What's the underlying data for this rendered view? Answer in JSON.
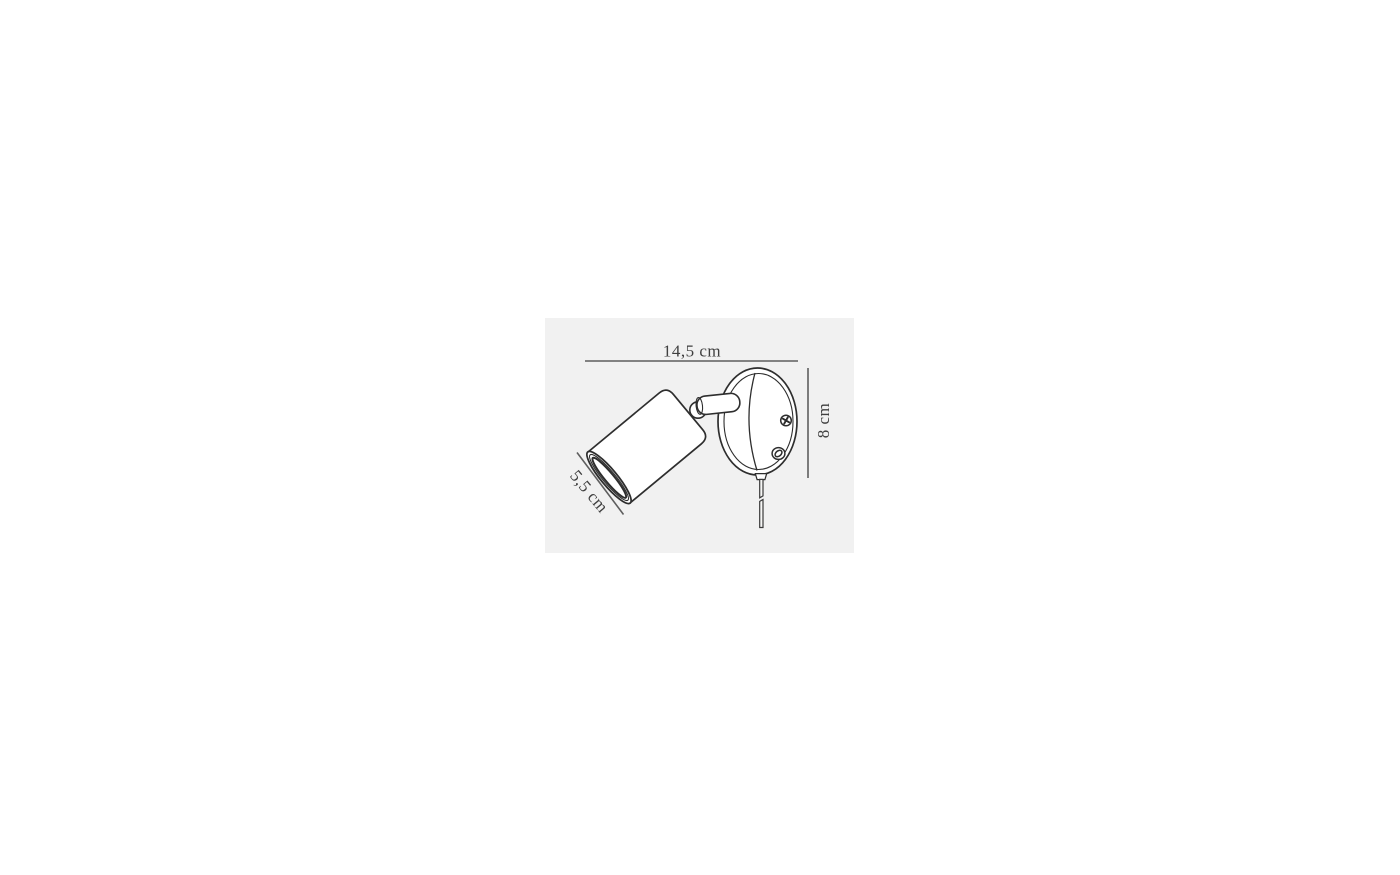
{
  "panel": {
    "background": "#f1f1f1"
  },
  "drawing": {
    "colors": {
      "outline": "#2e2e2e",
      "dimension_line": "#5e5e5e",
      "label_text": "#3f3f3f"
    },
    "labels": {
      "width": "14,5 cm",
      "height": "8 cm",
      "depth": "5,5 cm"
    }
  }
}
